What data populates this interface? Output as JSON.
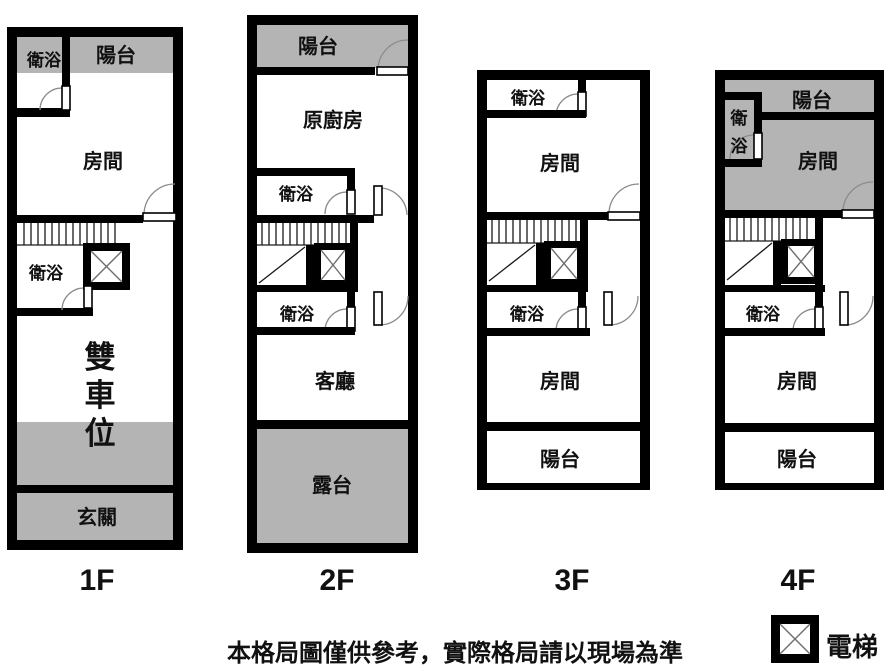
{
  "colors": {
    "wall": "#000000",
    "shaded_area": "#b4b4b4",
    "background": "#ffffff"
  },
  "floors": [
    {
      "label": "1F",
      "rooms": {
        "bath_top": "衛浴",
        "balcony": "陽台",
        "room": "房間",
        "bath_mid": "衛浴",
        "parking_chars": [
          "雙",
          "車",
          "位"
        ],
        "entry": "玄關"
      }
    },
    {
      "label": "2F",
      "rooms": {
        "balcony": "陽台",
        "kitchen": "原廚房",
        "bath_upper": "衛浴",
        "bath_lower": "衛浴",
        "living": "客廳",
        "terrace": "露台"
      }
    },
    {
      "label": "3F",
      "rooms": {
        "bath_upper": "衛浴",
        "room_upper": "房間",
        "bath_lower": "衛浴",
        "room_lower": "房間",
        "balcony": "陽台"
      }
    },
    {
      "label": "4F",
      "rooms": {
        "balcony_upper": "陽台",
        "bath_upper_chars": [
          "衛",
          "浴"
        ],
        "room_upper": "房間",
        "bath_lower": "衛浴",
        "room_lower": "房間",
        "balcony_lower": "陽台"
      }
    }
  ],
  "legend": {
    "elevator_label": "電梯"
  },
  "footer": {
    "disclaimer": "本格局圖僅供參考，實際格局請以現場為準"
  }
}
